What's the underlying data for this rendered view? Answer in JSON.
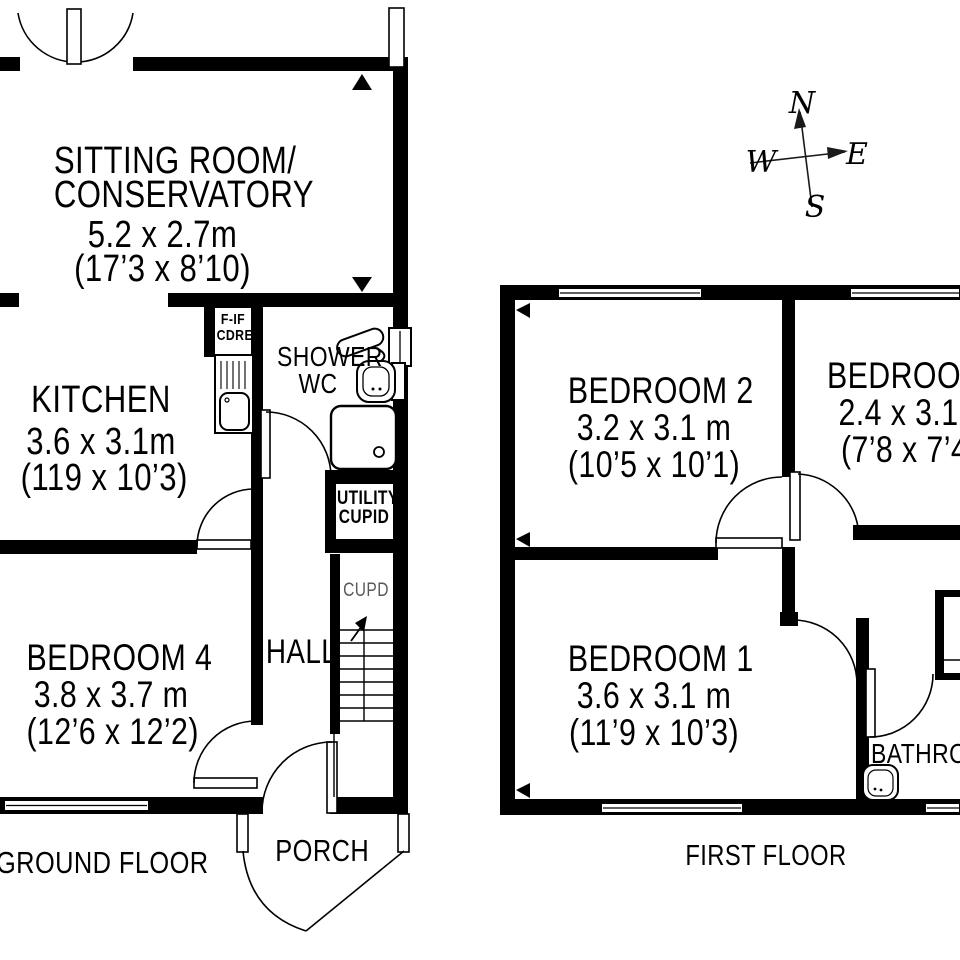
{
  "colors": {
    "wall": "#000000",
    "background": "#ffffff",
    "muted_text": "#595959"
  },
  "compass": {
    "n": "N",
    "w": "W",
    "e": "E",
    "s": "S"
  },
  "ground_floor": {
    "floor_label": "GROUND FLOOR",
    "sitting_room": {
      "name_line1": "SITTING ROOM/",
      "name_line2": "CONSERVATORY",
      "metric": "5.2 x 2.7m",
      "imperial": "(17’3 x 8’10)"
    },
    "kitchen": {
      "name": "KITCHEN",
      "metric": "3.6 x 3.1m",
      "imperial": "(119 x 10’3)"
    },
    "shower_wc": {
      "line1": "SHOWER",
      "line2": "WC"
    },
    "fridge_cupboard": {
      "line1": "F-IF",
      "line2": "CDRED"
    },
    "utility_cupboard": {
      "line1": "UTILITY",
      "line2": "CUPID"
    },
    "stairs_cupboard": "CUPD",
    "hall": "HALL",
    "bedroom_4": {
      "name": "BEDROOM 4",
      "metric": "3.8 x 3.7 m",
      "imperial": "(12’6 x 12’2)"
    },
    "porch": "PORCH"
  },
  "first_floor": {
    "floor_label": "FIRST FLOOR",
    "bedroom_2": {
      "name": "BEDROOM 2",
      "metric": "3.2 x 3.1 m",
      "imperial": "(10’5 x 10’1)"
    },
    "bedroom_3": {
      "name": "BEDROOM 3",
      "metric": "2.4 x 3.1 m",
      "imperial": "(7’8 x 7’4)"
    },
    "bedroom_1": {
      "name": "BEDROOM 1",
      "metric": "3.6 x 3.1 m",
      "imperial": "(11’9 x 10’3)"
    },
    "bathroom": "BATHROOM"
  }
}
